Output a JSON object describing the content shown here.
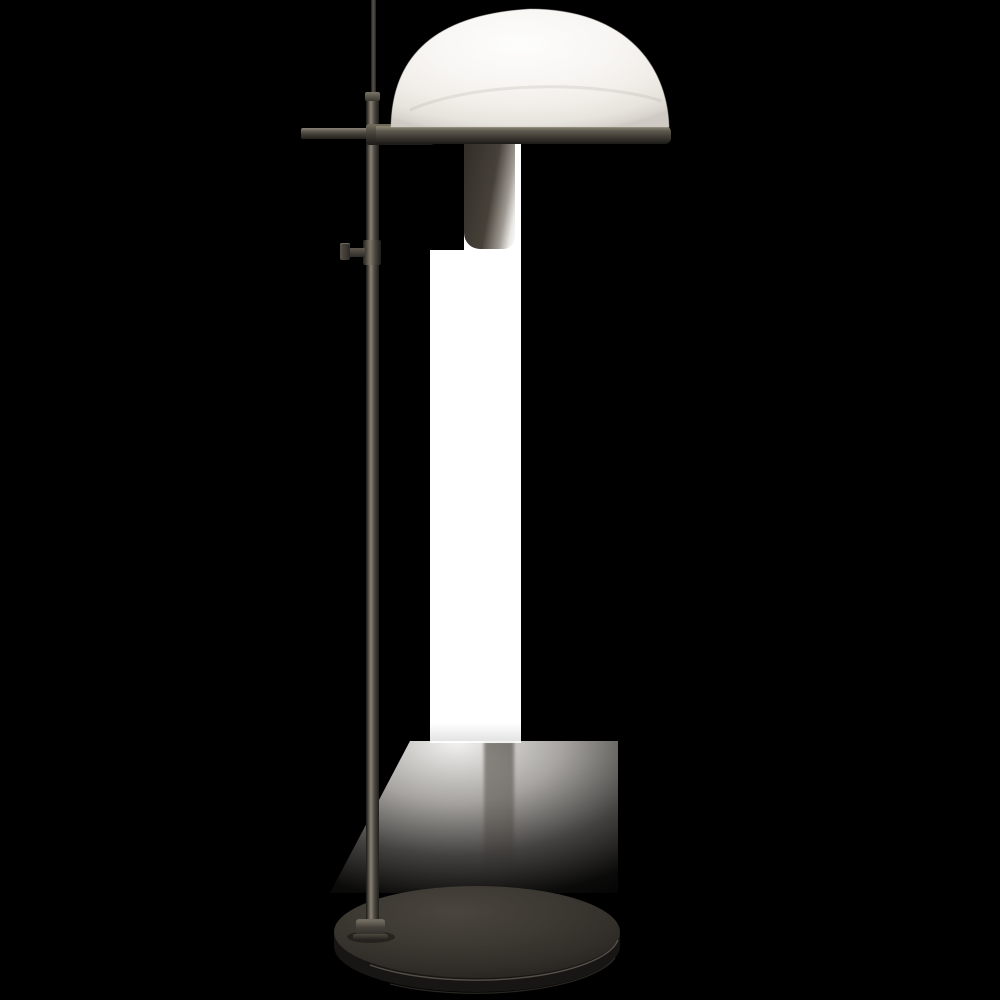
{
  "scene": {
    "type": "product-photograph",
    "subject": "adjustable floor lamp with white dome shade, bronze finish stem and round base",
    "background": "black (transparent cutout) with white studio-background remnant column and soft floor shadow",
    "visible_text": null
  },
  "lamp": {
    "parts": [
      {
        "name": "shade-dome",
        "description": "white hemispherical dome shade"
      },
      {
        "name": "shade-rim-band",
        "description": "dark bronze horizontal rim band under shade"
      },
      {
        "name": "crossbar",
        "description": "short bronze bar crossing the stem at the shade joint"
      },
      {
        "name": "stem-upper-rod",
        "description": "thin upper rod extending above the joint"
      },
      {
        "name": "stem-main-rod",
        "description": "main vertical bronze pole"
      },
      {
        "name": "adjustment-knob",
        "description": "small thumbscrew knob on left side of pole"
      },
      {
        "name": "base-collar",
        "description": "cylindrical collar where pole meets base"
      },
      {
        "name": "lamp-base",
        "description": "large round flat bronze base"
      }
    ]
  },
  "colors": {
    "canvas-bg": "#000000",
    "remnant-white": "#ffffff",
    "shade-white": "#f7f5f2",
    "shade-edge": "#d9d5ce",
    "metal-light": "#8a8375",
    "metal-mid": "#4e4a43",
    "metal-dark": "#201e1b",
    "base-top": "#3d3933",
    "base-side": "#181614",
    "shadow-gray": "#8f8c88"
  }
}
